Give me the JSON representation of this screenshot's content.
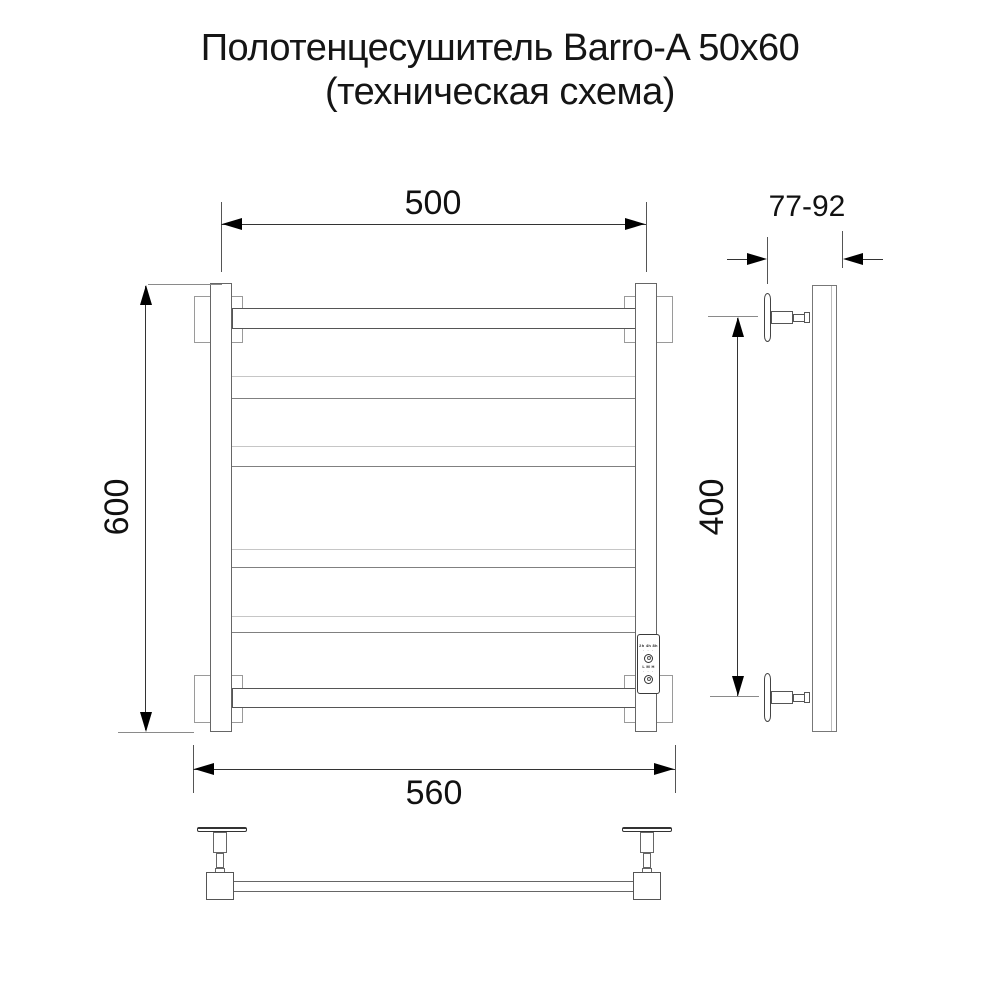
{
  "title": {
    "line1": "Полотенцесушитель Barro-A 50x60",
    "line2": "(техническая схема)"
  },
  "front_view": {
    "dim_top_width": "500",
    "dim_left_height": "600",
    "dim_bottom_width": "560",
    "control_panel": {
      "timer_row": "2h 4h 8h",
      "timer_dots": "· · ·",
      "mode_row": "L M H",
      "mode_dots": "· · ·",
      "icons": [
        "timer-button-icon",
        "power-button-icon"
      ]
    }
  },
  "side_view": {
    "dim_wall_distance": "77-92",
    "dim_right_height": "400"
  },
  "colors": {
    "line": "#555555",
    "light_line": "#c6c6c6",
    "bracket_line": "#9a9a9a",
    "arrow": "#000000",
    "background": "#ffffff",
    "text": "#111111"
  }
}
